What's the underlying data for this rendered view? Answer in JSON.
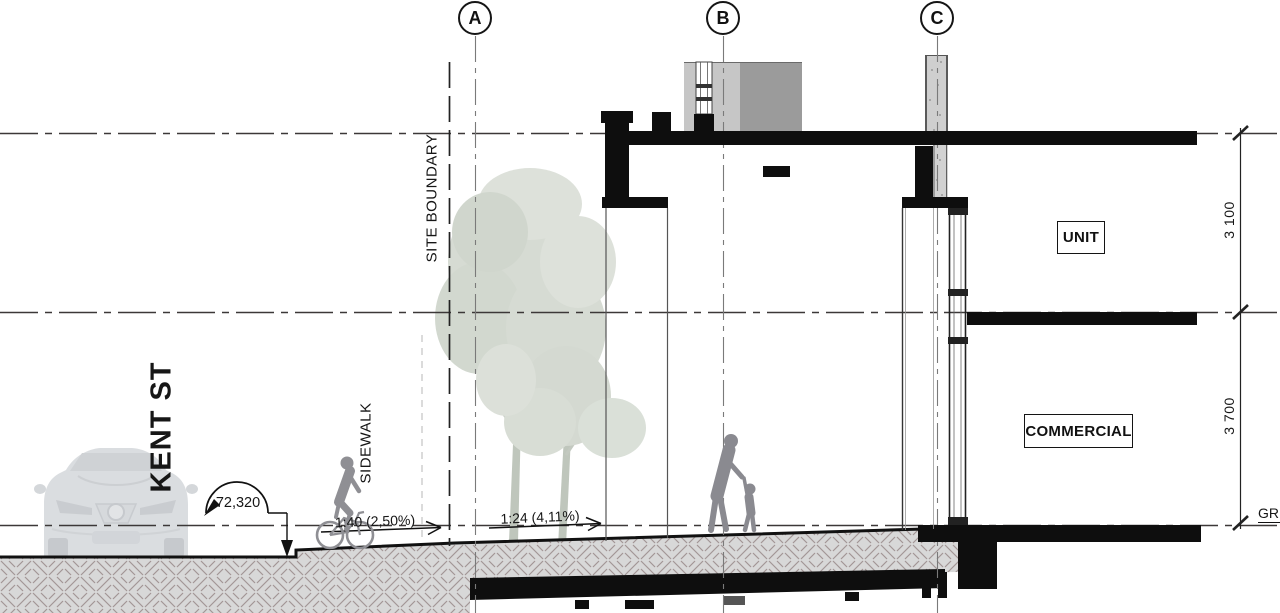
{
  "drawing_type": "architectural-section",
  "grid_bubbles": [
    {
      "label": "A"
    },
    {
      "label": "B"
    },
    {
      "label": "C"
    }
  ],
  "labels": {
    "street": "KENT ST",
    "sidewalk": "SIDEWALK",
    "site_boundary": "SITE BOUNDARY",
    "ground_level": "GR"
  },
  "annotations": {
    "road_level": "72,320",
    "slope_sidewalk": "1:40 (2,50%)",
    "slope_walkway": "1:24 (4,11%)"
  },
  "rooms": {
    "upper": "UNIT",
    "lower": "COMMERCIAL"
  },
  "dimensions": {
    "upper_floor_height": "3 100",
    "lower_floor_height": "3 700"
  },
  "colors": {
    "line": "#1c1c1c",
    "grid_line": "#7a7a7a",
    "earth_fill": "#d8d8d8",
    "earth_hatch_stroke": "#a29595",
    "slab_black": "#0e0e0e",
    "bulkhead_light": "#c6c6c6",
    "bulkhead_dark": "#9b9b9b",
    "concrete_wall": "#cfcfcf",
    "tree_foliage": "#d6dbd3",
    "figure_gray": "#8a8a90",
    "car_gray": "#b7bcc2"
  }
}
